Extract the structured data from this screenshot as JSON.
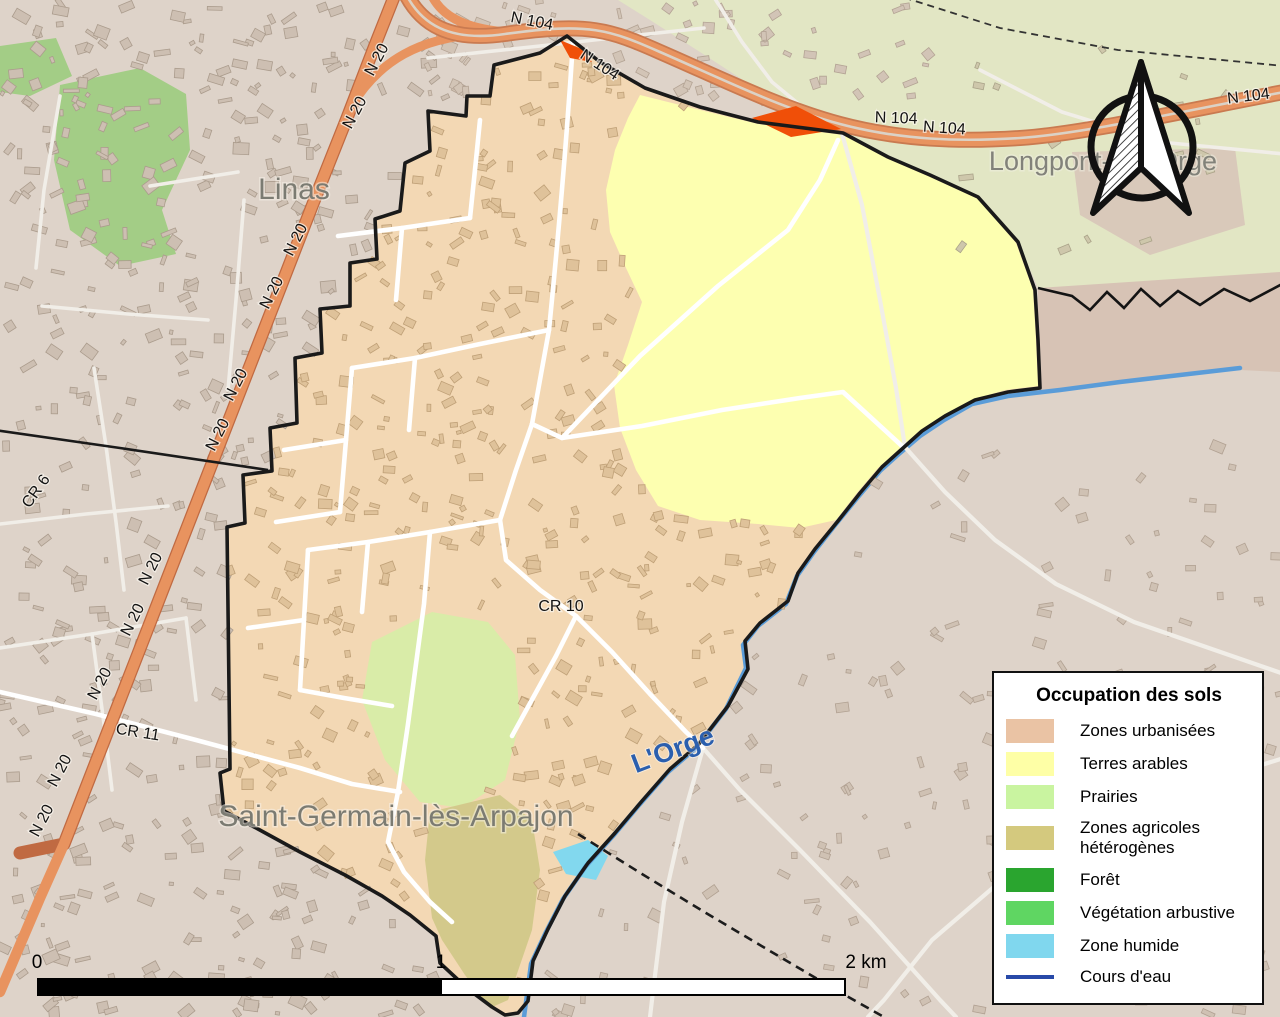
{
  "map": {
    "places": {
      "linas": "Linas",
      "longpont": "Longpont-sur-Orge",
      "saint_germain": "Saint-Germain-lès-Arpajon"
    },
    "water": {
      "river": "L'Orge"
    },
    "roads": {
      "n104": "N 104",
      "n20": "N 20",
      "cr6": "CR 6",
      "cr10": "CR 10",
      "cr11": "CR 11"
    }
  },
  "legend": {
    "title": "Occupation des sols",
    "items": [
      {
        "label": "Zones urbanisées",
        "color": "#eac3a4",
        "type": "swatch"
      },
      {
        "label": "Terres arables",
        "color": "#feffa6",
        "type": "swatch"
      },
      {
        "label": "Prairies",
        "color": "#c9f4a0",
        "type": "swatch"
      },
      {
        "label": "Zones agricoles hétérogènes",
        "color": "#d4c97e",
        "type": "swatch"
      },
      {
        "label": "Forêt",
        "color": "#2aa52f",
        "type": "swatch"
      },
      {
        "label": "Végétation arbustive",
        "color": "#5fd662",
        "type": "swatch"
      },
      {
        "label": "Zone humide",
        "color": "#80d7ee",
        "type": "swatch"
      },
      {
        "label": "Cours d'eau",
        "color": "#2849a8",
        "type": "line"
      }
    ]
  },
  "scalebar": {
    "start": "0",
    "middle": "1",
    "end": "2 km"
  },
  "colors": {
    "outside_west": "#ded3c9",
    "outside_fields": "#e2e6c4",
    "outside_east": "#d7c3b5",
    "commune_urban": "#f3d8b4",
    "terres_arables": "#fdffb0",
    "prairies": "#d9eca8",
    "zones_agricoles": "#d3c98b",
    "shrub_green": "#a3cd86",
    "road_national": "#e8935f",
    "river": "#5a9cd8",
    "industrial_red": "#f04f08",
    "wetland": "#82d8ee",
    "boundary": "#1a1a1a"
  }
}
